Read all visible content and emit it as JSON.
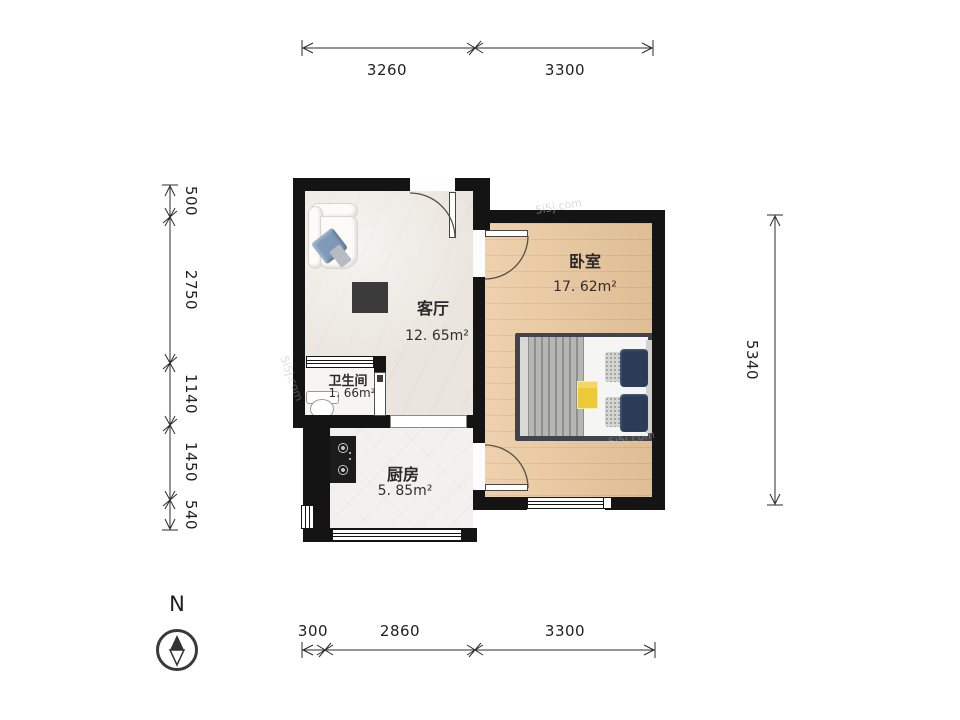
{
  "watermark": "5i5j.com",
  "compass": {
    "north_label": "N"
  },
  "rooms": {
    "bedroom": {
      "name": "卧室",
      "area": "17. 62m²"
    },
    "living_room": {
      "name": "客厅",
      "area": "12. 65m²"
    },
    "bathroom": {
      "name": "卫生间",
      "area": "1. 66m²"
    },
    "kitchen": {
      "name": "厨房",
      "area": "5. 85m²"
    }
  },
  "dimensions_mm": {
    "top": [
      "3260",
      "3300"
    ],
    "bottom": [
      "300",
      "2860",
      "3300"
    ],
    "left": [
      "500",
      "2750",
      "1140",
      "1450",
      "540"
    ],
    "right": [
      "5340"
    ]
  },
  "colors": {
    "wall": "#141414",
    "bedroom_floor": "#ebc89d",
    "living_floor": "#eae5de",
    "kitchen_floor": "#f2f1ef",
    "sofa_pillow_blue": "#7e9ab8",
    "bed_pillow_navy": "#2c3b58",
    "bed_blanket_gray": "#b6b6b4",
    "magazine_yellow": "#ecc937"
  }
}
